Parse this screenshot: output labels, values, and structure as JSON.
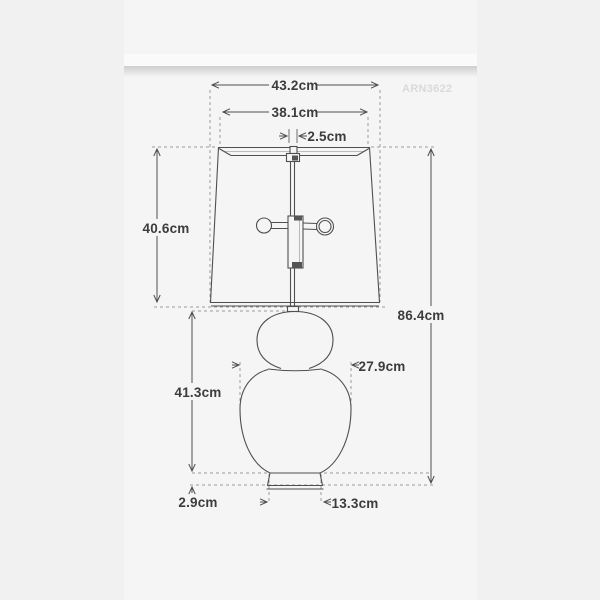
{
  "page": {
    "background": "#f1f1f1",
    "panel_background": "#f5f5f5"
  },
  "watermark": "ARN3622",
  "diagram": {
    "unit": "cm",
    "colors": {
      "line": "#4f4f4f",
      "dashed_line": "#9a9a9a",
      "label_text": "#3c3c3c",
      "watermark_text": "#dadada"
    },
    "dimensions": {
      "shade_bottom_width": "43.2cm",
      "shade_top_width": "38.1cm",
      "neck_width": "2.5cm",
      "shade_height": "40.6cm",
      "overall_height": "86.4cm",
      "body_height": "41.3cm",
      "body_width": "27.9cm",
      "base_height": "2.9cm",
      "base_width": "13.3cm"
    }
  }
}
